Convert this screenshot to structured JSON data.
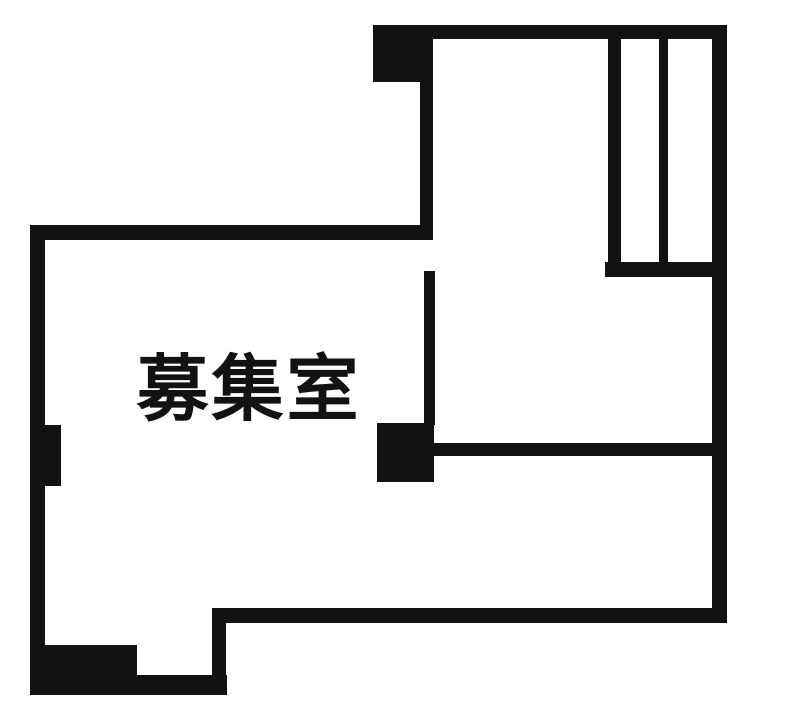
{
  "colors": {
    "wall": "#121212",
    "background": "#ffffff"
  },
  "room": {
    "label": "募集室"
  },
  "plan": {
    "width": 787,
    "height": 715,
    "walls": [
      {
        "name": "top-wall",
        "x": 373,
        "y": 25,
        "w": 354,
        "h": 14
      },
      {
        "name": "top-corner-block",
        "x": 373,
        "y": 25,
        "w": 60,
        "h": 57
      },
      {
        "name": "upper-room-left-wall",
        "x": 420,
        "y": 82,
        "w": 13,
        "h": 158
      },
      {
        "name": "main-room-top-wall",
        "x": 30,
        "y": 225,
        "w": 403,
        "h": 15
      },
      {
        "name": "left-wall",
        "x": 30,
        "y": 225,
        "w": 15,
        "h": 470
      },
      {
        "name": "left-wall-pillar",
        "x": 45,
        "y": 425,
        "w": 16,
        "h": 61
      },
      {
        "name": "entrance-block",
        "x": 45,
        "y": 645,
        "w": 92,
        "h": 50
      },
      {
        "name": "bottom-wall",
        "x": 30,
        "y": 675,
        "w": 197,
        "h": 20
      },
      {
        "name": "bottom-step-wall",
        "x": 212,
        "y": 608,
        "w": 14,
        "h": 87
      },
      {
        "name": "bottom-right-wall",
        "x": 212,
        "y": 608,
        "w": 515,
        "h": 15
      },
      {
        "name": "right-wall",
        "x": 712,
        "y": 25,
        "w": 15,
        "h": 598
      },
      {
        "name": "shaft-left-wall",
        "x": 608,
        "y": 27,
        "w": 13,
        "h": 250
      },
      {
        "name": "shaft-divider-wall",
        "x": 659,
        "y": 30,
        "w": 9,
        "h": 238
      },
      {
        "name": "shaft-bottom-wall",
        "x": 605,
        "y": 262,
        "w": 110,
        "h": 15
      },
      {
        "name": "partition-wall-vertical",
        "x": 424,
        "y": 271,
        "w": 11,
        "h": 154
      },
      {
        "name": "center-pillar",
        "x": 377,
        "y": 423,
        "w": 57,
        "h": 59
      },
      {
        "name": "partition-wall-horizontal",
        "x": 430,
        "y": 443,
        "w": 285,
        "h": 13
      }
    ]
  }
}
